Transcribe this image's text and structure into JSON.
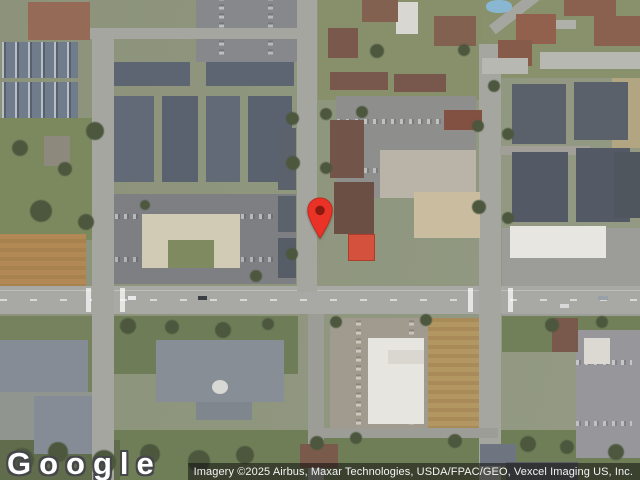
{
  "overlay": {
    "logo_text": "Google",
    "attribution_text": "Imagery ©2025 Airbus, Maxar Technologies, USDA/FPAC/GEO, Vexcel Imaging US, Inc."
  },
  "colors": {
    "pin_fill": "#EA3326",
    "pin_stroke": "#C3291C",
    "pin_inner": "#8A1A10",
    "road": "#A6A6A1",
    "grass": "#7B8A5C",
    "tree": "#4B573C",
    "attribution_bg": "rgba(15,15,15,0.55)"
  },
  "map": {
    "type": "satellite-imagery",
    "marker": {
      "name": "location-pin",
      "x": 320,
      "y": 238
    },
    "features": [
      {
        "n": "grass-left-field",
        "x": 0,
        "y": 118,
        "w": 92,
        "h": 122,
        "c": "#7b8a5c"
      },
      {
        "n": "dirt-field",
        "x": 0,
        "y": 234,
        "w": 86,
        "h": 54,
        "c": "#b5894f",
        "tx": "dirt"
      },
      {
        "n": "grass-left-bottom",
        "x": 0,
        "y": 316,
        "w": 94,
        "h": 164,
        "c": "#74825a"
      },
      {
        "n": "grass-center-south",
        "x": 114,
        "y": 316,
        "w": 184,
        "h": 58,
        "c": "#6d7d54"
      },
      {
        "n": "grass-bottom-wide",
        "x": 110,
        "y": 430,
        "w": 530,
        "h": 50,
        "c": "#6f7f55"
      },
      {
        "n": "grass-right-south",
        "x": 502,
        "y": 316,
        "w": 140,
        "h": 36,
        "c": "#718157"
      },
      {
        "n": "grass-top-center",
        "x": 318,
        "y": 0,
        "w": 164,
        "h": 100,
        "c": "#879067"
      },
      {
        "n": "grass-top-right",
        "x": 482,
        "y": 0,
        "w": 158,
        "h": 78,
        "c": "#889169"
      },
      {
        "n": "scrub-bottom-left",
        "x": 0,
        "y": 440,
        "w": 120,
        "h": 40,
        "c": "#5f6c49"
      },
      {
        "n": "parking-top",
        "x": 196,
        "y": 0,
        "w": 102,
        "h": 62,
        "c": "#86888b",
        "tx": "cars-v"
      },
      {
        "n": "plaza-parking",
        "x": 114,
        "y": 194,
        "w": 182,
        "h": 90,
        "c": "#7d7f82",
        "tx": "cars-h"
      },
      {
        "n": "parking-center",
        "x": 336,
        "y": 96,
        "w": 140,
        "h": 102,
        "c": "#8e8f8d",
        "tx": "cars-h"
      },
      {
        "n": "store-apron",
        "x": 380,
        "y": 150,
        "w": 96,
        "h": 48,
        "c": "#b9b4a6"
      },
      {
        "n": "parking-bottom-center",
        "x": 330,
        "y": 318,
        "w": 112,
        "h": 120,
        "c": "#a19b8e",
        "tx": "cars-v"
      },
      {
        "n": "dirt-lot",
        "x": 428,
        "y": 318,
        "w": 52,
        "h": 112,
        "c": "#b5975e",
        "tx": "dirt"
      },
      {
        "n": "parking-right-bottom",
        "x": 576,
        "y": 330,
        "w": 64,
        "h": 128,
        "c": "#97979b",
        "tx": "cars-h"
      },
      {
        "n": "paved-right-mid",
        "x": 502,
        "y": 228,
        "w": 140,
        "h": 88,
        "c": "#9c9c98"
      },
      {
        "n": "dirt-strip-right",
        "x": 612,
        "y": 78,
        "w": 28,
        "h": 70,
        "c": "#b3a57f"
      },
      {
        "n": "parking-bottom-left",
        "x": 0,
        "y": 392,
        "w": 96,
        "h": 48,
        "c": "#90958f"
      },
      {
        "n": "road-main",
        "x": 0,
        "y": 286,
        "w": 640,
        "h": 28,
        "c": "#a8a8a4",
        "tx": "road-h"
      },
      {
        "n": "road-left-vertical",
        "x": 92,
        "y": 30,
        "w": 22,
        "h": 450,
        "c": "#a6a6a1"
      },
      {
        "n": "road-top-horizontal",
        "x": 80,
        "y": 28,
        "w": 222,
        "h": 11,
        "c": "#a6a6a1"
      },
      {
        "n": "road-center-vertical",
        "x": 297,
        "y": 0,
        "w": 20,
        "h": 292,
        "c": "#a6a6a1"
      },
      {
        "n": "road-center-vertical-lower",
        "x": 308,
        "y": 314,
        "w": 16,
        "h": 166,
        "c": "#9d9d98"
      },
      {
        "n": "road-right-vertical",
        "x": 479,
        "y": 44,
        "w": 22,
        "h": 436,
        "c": "#a6a6a1"
      },
      {
        "n": "road-right-diagonal",
        "x": 486,
        "y": 6,
        "w": 60,
        "h": 11,
        "c": "#a6a6a1",
        "rot": -38
      },
      {
        "n": "road-right-spur",
        "x": 500,
        "y": 146,
        "w": 90,
        "h": 9,
        "c": "#a29f97"
      },
      {
        "n": "road-bottom-loop",
        "x": 322,
        "y": 428,
        "w": 176,
        "h": 10,
        "c": "#9d9d98"
      },
      {
        "n": "road-top-right",
        "x": 524,
        "y": 20,
        "w": 52,
        "h": 9,
        "c": "#b0b0aa"
      },
      {
        "n": "crosswalk-left-1",
        "x": 86,
        "y": 288,
        "w": 5,
        "h": 24,
        "c": "rgba(255,255,255,0.7)"
      },
      {
        "n": "crosswalk-left-2",
        "x": 120,
        "y": 288,
        "w": 5,
        "h": 24,
        "c": "rgba(255,255,255,0.7)"
      },
      {
        "n": "crosswalk-right-1",
        "x": 468,
        "y": 288,
        "w": 5,
        "h": 24,
        "c": "rgba(255,255,255,0.7)"
      },
      {
        "n": "crosswalk-right-2",
        "x": 508,
        "y": 288,
        "w": 5,
        "h": 24,
        "c": "rgba(255,255,255,0.7)"
      },
      {
        "n": "house-top-left",
        "x": 28,
        "y": 2,
        "w": 62,
        "h": 38,
        "c": "#986a55"
      },
      {
        "n": "townhome-row-1",
        "x": 2,
        "y": 42,
        "w": 76,
        "h": 36,
        "c": "#6f7c8c",
        "tx": "gables"
      },
      {
        "n": "townhome-row-2",
        "x": 2,
        "y": 82,
        "w": 76,
        "h": 36,
        "c": "#6f7c8c",
        "tx": "gables"
      },
      {
        "n": "barn",
        "x": 44,
        "y": 136,
        "w": 26,
        "h": 30,
        "c": "#8e897c"
      },
      {
        "n": "apartment-nw-1",
        "x": 114,
        "y": 62,
        "w": 76,
        "h": 24,
        "c": "#5d6573"
      },
      {
        "n": "apartment-nw-2",
        "x": 206,
        "y": 62,
        "w": 88,
        "h": 24,
        "c": "#5d6573"
      },
      {
        "n": "apartment-col-1",
        "x": 114,
        "y": 96,
        "w": 40,
        "h": 86,
        "c": "#626a78"
      },
      {
        "n": "apartment-col-2",
        "x": 162,
        "y": 96,
        "w": 36,
        "h": 86,
        "c": "#596170"
      },
      {
        "n": "apartment-col-3",
        "x": 206,
        "y": 96,
        "w": 34,
        "h": 86,
        "c": "#626a78"
      },
      {
        "n": "apartment-col-4",
        "x": 248,
        "y": 96,
        "w": 44,
        "h": 86,
        "c": "#596170"
      },
      {
        "n": "plaza-building",
        "x": 142,
        "y": 214,
        "w": 98,
        "h": 54,
        "c": "#d2cab3"
      },
      {
        "n": "plaza-courtyard",
        "x": 168,
        "y": 240,
        "w": 46,
        "h": 28,
        "c": "#7e8a5e"
      },
      {
        "n": "apartment-west-road-1",
        "x": 278,
        "y": 128,
        "w": 18,
        "h": 62,
        "c": "#5a626d"
      },
      {
        "n": "apartment-west-road-2",
        "x": 278,
        "y": 196,
        "w": 18,
        "h": 36,
        "c": "#5a626d"
      },
      {
        "n": "apartment-west-road-3",
        "x": 278,
        "y": 238,
        "w": 18,
        "h": 40,
        "c": "#555d68"
      },
      {
        "n": "brown-house-center",
        "x": 328,
        "y": 28,
        "w": 30,
        "h": 30,
        "c": "#7c584a"
      },
      {
        "n": "white-building-top",
        "x": 396,
        "y": 2,
        "w": 22,
        "h": 32,
        "c": "#d8d7d2"
      },
      {
        "n": "house-top-center-1",
        "x": 362,
        "y": 0,
        "w": 36,
        "h": 22,
        "c": "#84604f"
      },
      {
        "n": "house-top-center-2",
        "x": 434,
        "y": 16,
        "w": 42,
        "h": 30,
        "c": "#84604f"
      },
      {
        "n": "brown-row-1",
        "x": 330,
        "y": 72,
        "w": 58,
        "h": 18,
        "c": "#7a574a"
      },
      {
        "n": "brown-row-2",
        "x": 394,
        "y": 74,
        "w": 52,
        "h": 18,
        "c": "#7a574a"
      },
      {
        "n": "brown-apartment-1",
        "x": 330,
        "y": 120,
        "w": 34,
        "h": 58,
        "c": "#755447"
      },
      {
        "n": "brown-apartment-2",
        "x": 334,
        "y": 182,
        "w": 40,
        "h": 52,
        "c": "#6e4f43"
      },
      {
        "n": "brown-building-small",
        "x": 444,
        "y": 110,
        "w": 38,
        "h": 20,
        "c": "#85503f"
      },
      {
        "n": "tan-store",
        "x": 414,
        "y": 192,
        "w": 66,
        "h": 46,
        "c": "#cbbd9c"
      },
      {
        "n": "tennis-court",
        "x": 348,
        "y": 234,
        "w": 27,
        "h": 27,
        "c": "#dd4f3a",
        "bd": "#b53a28"
      },
      {
        "n": "pool",
        "x": 486,
        "y": 0,
        "w": 26,
        "h": 13,
        "c": "#86b7d4",
        "r": "45%"
      },
      {
        "n": "house-right-1",
        "x": 516,
        "y": 14,
        "w": 40,
        "h": 30,
        "c": "#94604c"
      },
      {
        "n": "house-right-2",
        "x": 498,
        "y": 40,
        "w": 34,
        "h": 26,
        "c": "#8a5a48"
      },
      {
        "n": "house-right-3",
        "x": 564,
        "y": 0,
        "w": 52,
        "h": 16,
        "c": "#8d5f4d"
      },
      {
        "n": "house-right-4",
        "x": 594,
        "y": 16,
        "w": 46,
        "h": 30,
        "c": "#8d5f4d"
      },
      {
        "n": "carport-right-1",
        "x": 540,
        "y": 52,
        "w": 100,
        "h": 17,
        "c": "#b8b8b2"
      },
      {
        "n": "carport-right-2",
        "x": 482,
        "y": 58,
        "w": 46,
        "h": 16,
        "c": "#b8b8b2"
      },
      {
        "n": "apartment-right-1",
        "x": 512,
        "y": 84,
        "w": 54,
        "h": 60,
        "c": "#59616c"
      },
      {
        "n": "apartment-right-2",
        "x": 574,
        "y": 82,
        "w": 54,
        "h": 58,
        "c": "#59616c"
      },
      {
        "n": "apartment-right-3",
        "x": 512,
        "y": 152,
        "w": 56,
        "h": 70,
        "c": "#525a66"
      },
      {
        "n": "apartment-right-4",
        "x": 576,
        "y": 148,
        "w": 54,
        "h": 74,
        "c": "#525a66"
      },
      {
        "n": "apartment-right-5",
        "x": 614,
        "y": 152,
        "w": 26,
        "h": 66,
        "c": "#4e565f"
      },
      {
        "n": "commercial-white-building",
        "x": 510,
        "y": 226,
        "w": 96,
        "h": 32,
        "c": "#e7e6e0"
      },
      {
        "n": "brown-building-south-right",
        "x": 552,
        "y": 318,
        "w": 26,
        "h": 34,
        "c": "#7b584a"
      },
      {
        "n": "white-building-south-right",
        "x": 584,
        "y": 338,
        "w": 26,
        "h": 26,
        "c": "#dcd9d1"
      },
      {
        "n": "complex-bottom-1",
        "x": 0,
        "y": 340,
        "w": 88,
        "h": 52,
        "c": "#858c96"
      },
      {
        "n": "complex-bottom-2",
        "x": 34,
        "y": 396,
        "w": 58,
        "h": 58,
        "c": "#858c96"
      },
      {
        "n": "church-building",
        "x": 156,
        "y": 340,
        "w": 128,
        "h": 62,
        "c": "#878e96"
      },
      {
        "n": "church-wing",
        "x": 196,
        "y": 402,
        "w": 56,
        "h": 18,
        "c": "#7f868f"
      },
      {
        "n": "church-dome",
        "x": 212,
        "y": 380,
        "w": 16,
        "h": 14,
        "c": "#d8d8d4",
        "r": "50%"
      },
      {
        "n": "white-building-bottom",
        "x": 368,
        "y": 338,
        "w": 56,
        "h": 86,
        "c": "#e6e5df"
      },
      {
        "n": "white-building-bottom-wing",
        "x": 388,
        "y": 350,
        "w": 36,
        "h": 14,
        "c": "#d9d7cf"
      },
      {
        "n": "house-bottom-1",
        "x": 300,
        "y": 444,
        "w": 38,
        "h": 24,
        "c": "#7b5a49"
      },
      {
        "n": "house-bottom-2",
        "x": 480,
        "y": 444,
        "w": 36,
        "h": 22,
        "c": "#6d7582"
      },
      {
        "n": "dark-row-bottom",
        "x": 506,
        "y": 462,
        "w": 72,
        "h": 18,
        "c": "#5c6066"
      },
      {
        "n": "vehicle-1",
        "x": 128,
        "y": 296,
        "w": 8,
        "h": 4,
        "c": "#e8e8e8"
      },
      {
        "n": "vehicle-2",
        "x": 198,
        "y": 296,
        "w": 9,
        "h": 4,
        "c": "#3a3f45"
      },
      {
        "n": "vehicle-3",
        "x": 560,
        "y": 304,
        "w": 9,
        "h": 4,
        "c": "#d8d8d8"
      },
      {
        "n": "vehicle-4",
        "x": 598,
        "y": 296,
        "w": 10,
        "h": 4,
        "c": "#9aa0a8"
      }
    ],
    "trees": [
      [
        86,
        122,
        18
      ],
      [
        12,
        140,
        16
      ],
      [
        58,
        162,
        14
      ],
      [
        30,
        200,
        22
      ],
      [
        78,
        214,
        16
      ],
      [
        120,
        318,
        16
      ],
      [
        165,
        320,
        14
      ],
      [
        215,
        322,
        16
      ],
      [
        262,
        318,
        12
      ],
      [
        330,
        316,
        12
      ],
      [
        420,
        314,
        12
      ],
      [
        545,
        318,
        14
      ],
      [
        596,
        316,
        12
      ],
      [
        286,
        112,
        13
      ],
      [
        320,
        108,
        12
      ],
      [
        286,
        156,
        14
      ],
      [
        320,
        162,
        12
      ],
      [
        286,
        248,
        12
      ],
      [
        472,
        120,
        12
      ],
      [
        502,
        128,
        12
      ],
      [
        472,
        200,
        14
      ],
      [
        502,
        212,
        12
      ],
      [
        356,
        106,
        12
      ],
      [
        370,
        44,
        14
      ],
      [
        458,
        44,
        12
      ],
      [
        488,
        80,
        12
      ],
      [
        10,
        448,
        24
      ],
      [
        48,
        442,
        20
      ],
      [
        92,
        450,
        24
      ],
      [
        140,
        444,
        20
      ],
      [
        188,
        450,
        22
      ],
      [
        236,
        446,
        18
      ],
      [
        310,
        436,
        14
      ],
      [
        350,
        432,
        12
      ],
      [
        448,
        434,
        14
      ],
      [
        520,
        436,
        16
      ],
      [
        560,
        440,
        14
      ],
      [
        608,
        444,
        16
      ],
      [
        250,
        270,
        12
      ],
      [
        140,
        200,
        10
      ]
    ]
  }
}
